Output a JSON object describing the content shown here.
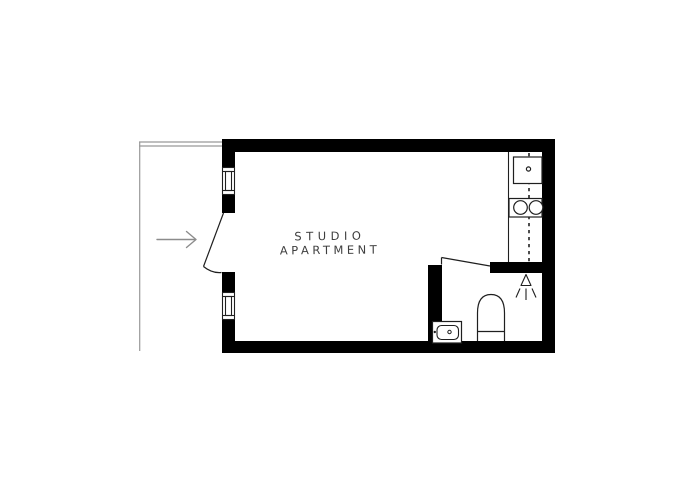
{
  "floor_plan": {
    "room_label_line1": "STUDIO",
    "room_label_line2": "APARTMENT",
    "colors": {
      "background": "#ffffff",
      "wall": "#000000",
      "fixture_line": "#1f1f1f",
      "corridor_line": "#999999",
      "entrance_arrow": "#8c8c8c",
      "label_text": "#3e3e3e"
    },
    "icons": {
      "entrance": "entrance-arrow-icon",
      "entrance_door": "entrance-door-icon",
      "windows": [
        "window-upper-icon",
        "window-lower-icon"
      ],
      "kitchen": [
        "kitchen-sink-icon",
        "stove-burners-icon",
        "upper-cabinet-dashed-line"
      ],
      "bathroom": [
        "bathroom-door-icon",
        "shower-icon",
        "toilet-icon",
        "bathroom-sink-icon"
      ]
    }
  }
}
